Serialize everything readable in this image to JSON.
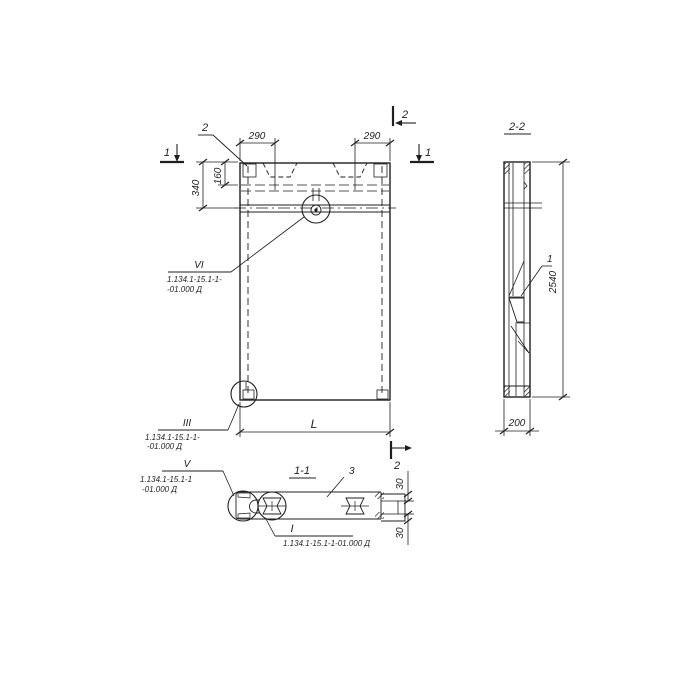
{
  "colors": {
    "ink": "#1f1f1f",
    "paper": "#ffffff"
  },
  "plan": {
    "corner_detail_leader": "2",
    "cut1_left": "1",
    "cut1_right": "1",
    "cut2_top": "2",
    "cut2_bottom": "2",
    "dim_290_left": "290",
    "dim_290_right": "290",
    "dim_340": "340",
    "dim_160": "160",
    "dim_length": "L",
    "callout_vi": {
      "numeral": "VI",
      "line1": "1.134.1-15.1-1-",
      "line2": "-01.000 Д"
    },
    "callout_iii": {
      "numeral": "III",
      "line1": "1.134.1-15.1-1-",
      "line2": "-01.000 Д"
    }
  },
  "section22": {
    "title": "2-2",
    "dim_height": "2540",
    "dim_width": "200",
    "part": "1"
  },
  "section11": {
    "title": "1-1",
    "part": "3",
    "dim_30_top": "30",
    "dim_30_bottom": "30",
    "callout_v": {
      "numeral": "V",
      "line1": "1.134.1-15.1-1",
      "line2": "-01.000 Д"
    },
    "callout_i": {
      "numeral": "I",
      "line": "1.134.1-15.1-1-01.000 Д"
    }
  }
}
